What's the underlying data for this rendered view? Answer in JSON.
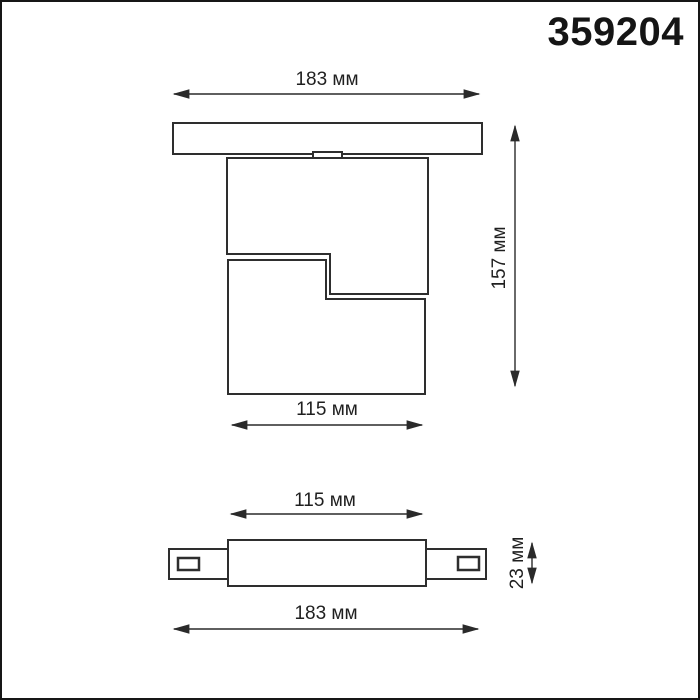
{
  "product_number": "359204",
  "views": {
    "front": {
      "plate_width_label": "183 мм",
      "height_label": "157 мм",
      "body_width_label": "115 мм"
    },
    "adapter": {
      "inner_width_label": "115 мм",
      "height_label": "23 мм",
      "total_width_label": "183 мм"
    }
  },
  "colors": {
    "object_line": "#2e2e2e",
    "dimension_line": "#2a2a2a",
    "text": "#1f1f1f",
    "background": "#ffffff",
    "frame_border": "#161616"
  }
}
